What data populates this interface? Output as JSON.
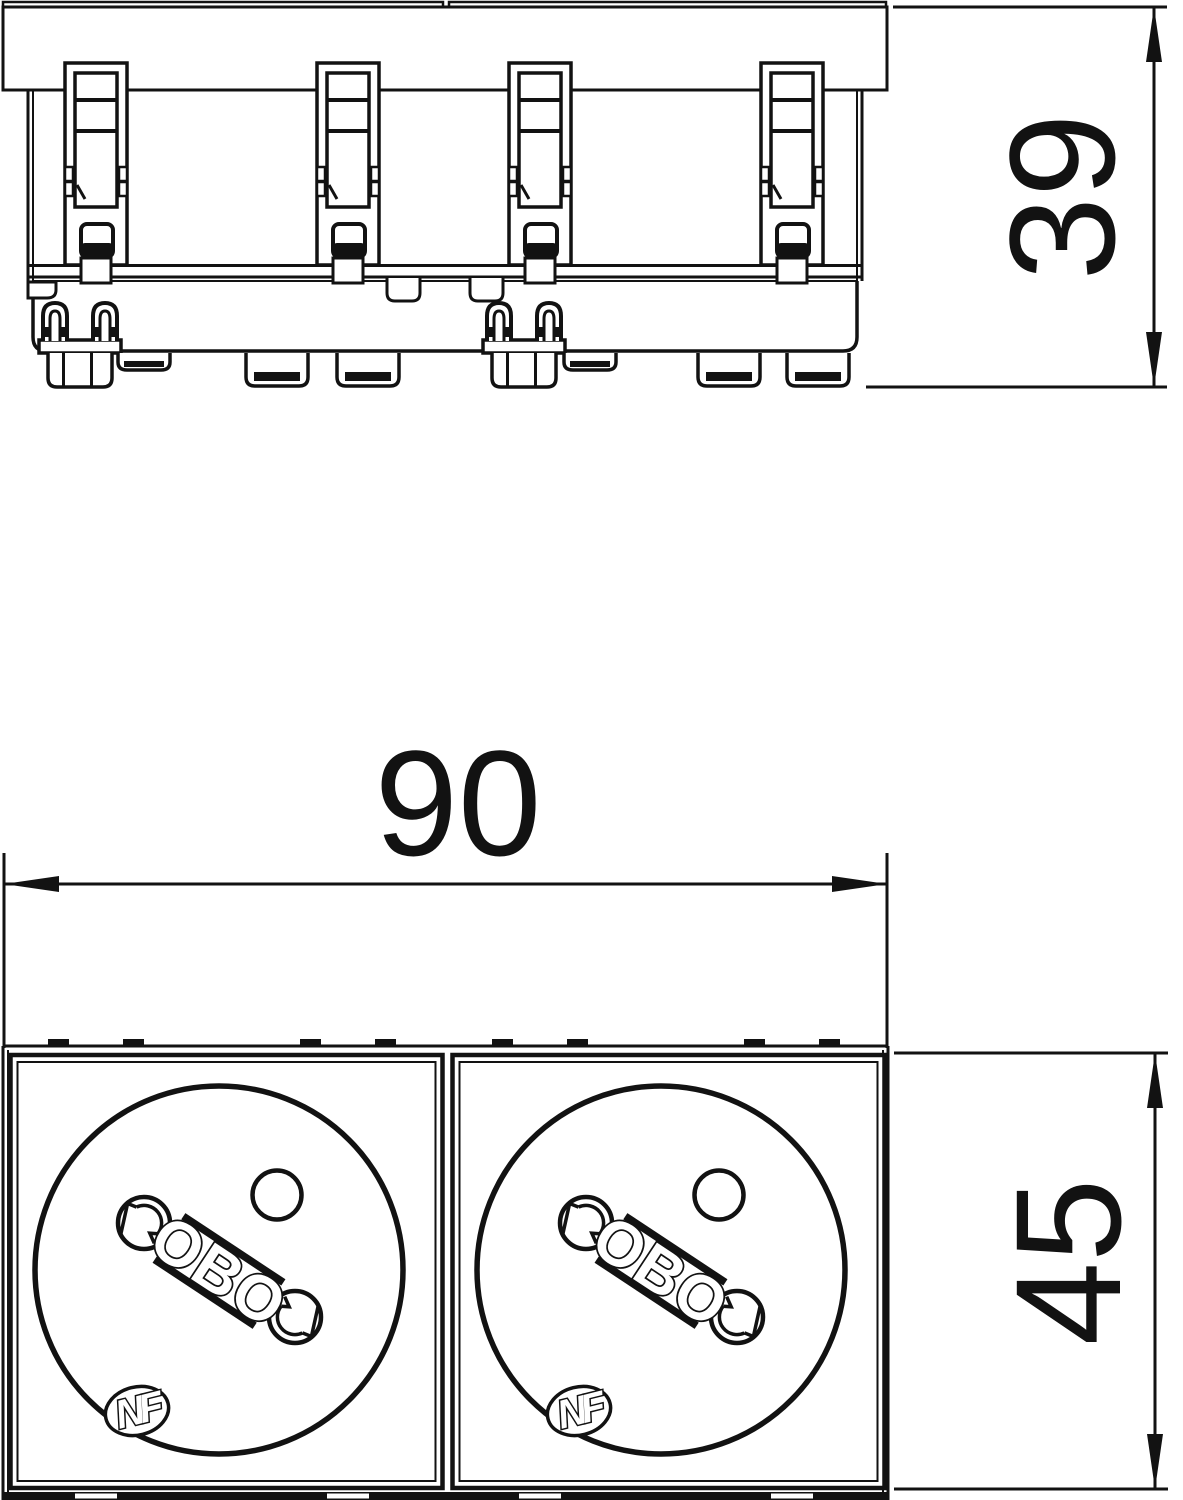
{
  "page": {
    "background": "#ffffff",
    "line_color": "#121212",
    "description_texts": []
  },
  "views": {
    "side": {
      "dimension_height_label": "39"
    },
    "front": {
      "dimension_width_label": "90",
      "dimension_height_label": "45",
      "socket": {
        "brand_mark": "OBO",
        "certification_mark": "NF"
      }
    }
  }
}
